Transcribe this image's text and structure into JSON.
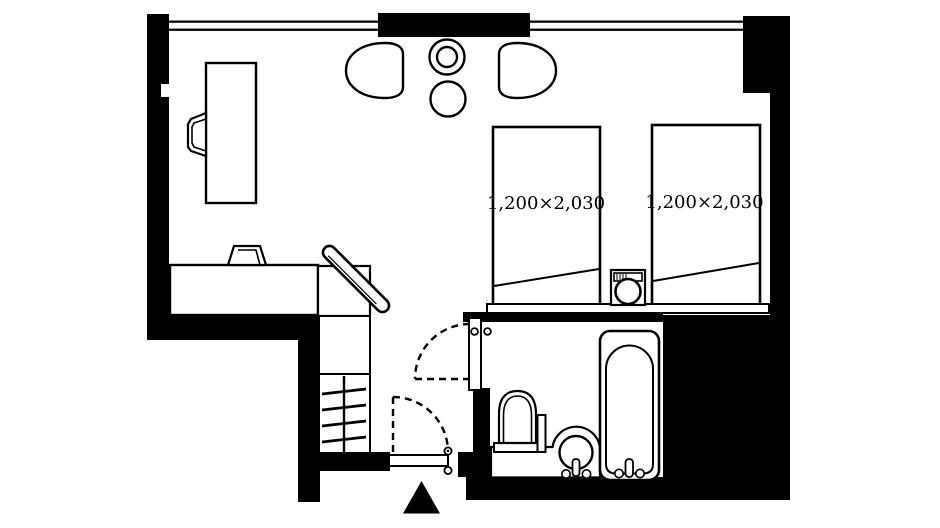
{
  "page": {
    "background": "#ffffff"
  },
  "floorplan": {
    "type": "hotel-twin-room-floor-plan",
    "wall_color": "#000000",
    "floor_color": "#ffffff",
    "line_color": "#000000",
    "beds": [
      {
        "id": "bed-1",
        "label": "1,200×2,030"
      },
      {
        "id": "bed-2",
        "label": "1,200×2,030"
      }
    ],
    "fixtures": [
      "window",
      "desk",
      "desk-chair",
      "lounge-chair-left",
      "lounge-chair-right",
      "lamp-table",
      "round-table",
      "counter",
      "stool",
      "full-length-mirror",
      "mirror-cabinet",
      "closet-shelf",
      "closet-hangers",
      "twin-bed",
      "twin-bed",
      "nightstand",
      "headboard",
      "entry-door",
      "bathroom-door",
      "toilet",
      "vanity-sink",
      "bathtub",
      "entrance-arrow"
    ]
  }
}
